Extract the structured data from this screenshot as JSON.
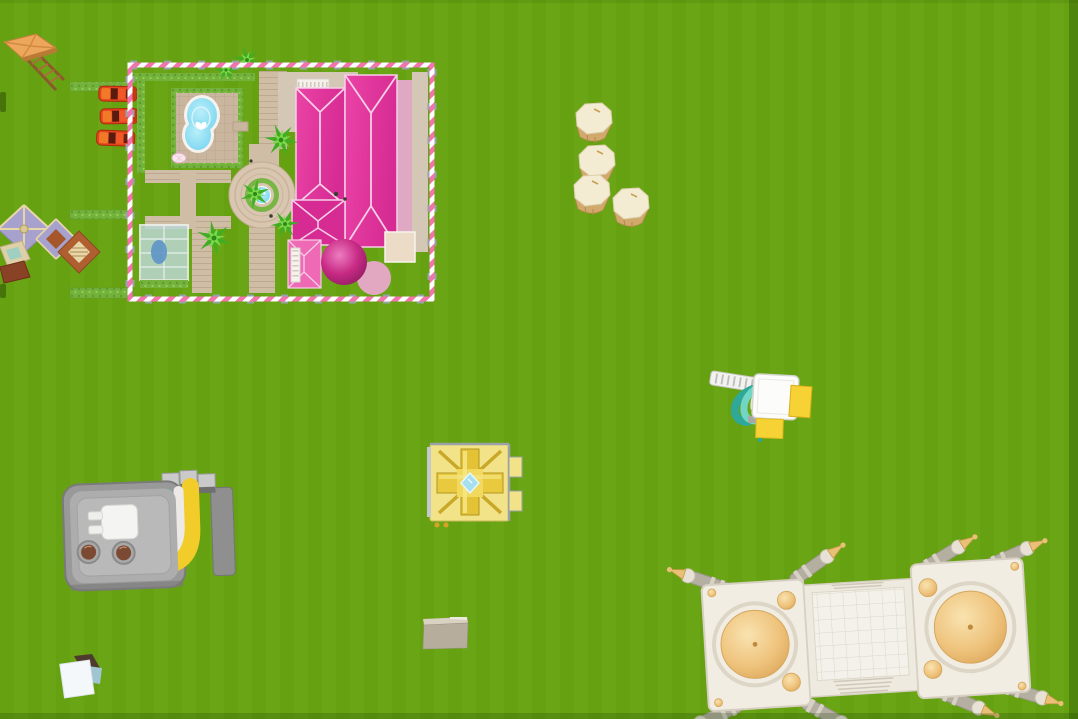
{
  "meta": {
    "view": "aerial-top-down-game-world",
    "description": "Top-down aerial view of a colorful toy sandbox game world on a bright green field"
  },
  "scene": {
    "field_label": "grass field",
    "objects": [
      {
        "id": "watchtower",
        "label": "Wooden watchtower with orange canopy roof"
      },
      {
        "id": "sports-cars",
        "label": "Row of parked red sports cars",
        "count": 3
      },
      {
        "id": "dream-mansion",
        "label": "Pink dream mansion compound with candy-stripe fence, pool, fountain, greenhouse and palm trees"
      },
      {
        "id": "pagoda",
        "label": "Tiered pagoda pavilion with lavender and brown roofs"
      },
      {
        "id": "barrels",
        "label": "Cream-topped wooden barrels",
        "count": 4
      },
      {
        "id": "slide-playset",
        "label": "Toy playset with teal slides, white ladder and yellow pads"
      },
      {
        "id": "golden-shrine",
        "label": "Golden shrine block with cyan gem center"
      },
      {
        "id": "toaster-machine",
        "label": "Grey toaster-like machine with plug, knobs and toy slides"
      },
      {
        "id": "white-crate",
        "label": "Small white crate"
      },
      {
        "id": "concrete-slab",
        "label": "Concrete slab block"
      },
      {
        "id": "palace",
        "label": "White palace with golden domes, tiled courtyard and minarets"
      }
    ]
  },
  "colors": {
    "grass": "#68a412",
    "grass-shade": "#55900c",
    "fence-pink": "#f373ac",
    "fence-white": "#ffffff",
    "fence-post": "#98a2aa",
    "hedge": "#74b23c",
    "hedge-dark": "#5d9b33",
    "patio": "#cab69e",
    "grout": "#b7a288",
    "pool-water": "#74d4ef",
    "path": "#cfbda6",
    "path-line": "#bda98f",
    "terrace": "#d5c7b5",
    "balcony": "#f5f1ea",
    "roof-magenta": "#e0339c",
    "roof-deep": "#d62b93",
    "roof-light": "#ef6ab5",
    "roof-trim": "#f6cfe7",
    "east-pink": "#dfa9c4",
    "sphere-pink": "#c2267e",
    "pad-pink": "#e2a8c2",
    "palm-dark": "#3fae22",
    "palm-light": "#7ed84a",
    "car-red": "#e6441c",
    "car-accent": "#f07a28",
    "wood-frame": "#8a5a2a",
    "wood-roof": "#eda75c",
    "pagoda-purple": "#a7a1ce",
    "pagoda-brown": "#b06030",
    "pagoda-cream": "#e7d7a8",
    "barrel-top": "#f4ebd3",
    "barrel-side": "#d2a96c",
    "teal-dark": "#2fa898",
    "teal-light": "#72d6c6",
    "toy-yellow": "#f6d234",
    "toy-white": "#fcfcfa",
    "shrine-base": "#f2e388",
    "shrine-gold": "#e3c235",
    "shrine-gem": "#a6e0ee",
    "machine-grey": "#999999",
    "machine-panel": "#b9b9b9",
    "knob-brown": "#7c4a33",
    "plug-white": "#f4f4f2",
    "palace": "#f1ede3",
    "palace-trim": "#d7d0c2",
    "dome-gold": "#e9c077",
    "minaret-grey": "#b5afa2",
    "slab": "#b6ad9d",
    "crate-white": "#f5f8fa",
    "crate-dark": "#4f3b2e",
    "glass": "#bcd8d4",
    "pond": "#5e93c8",
    "fountain-stone": "#d9c6b1",
    "water-blue": "#6fcfee"
  }
}
